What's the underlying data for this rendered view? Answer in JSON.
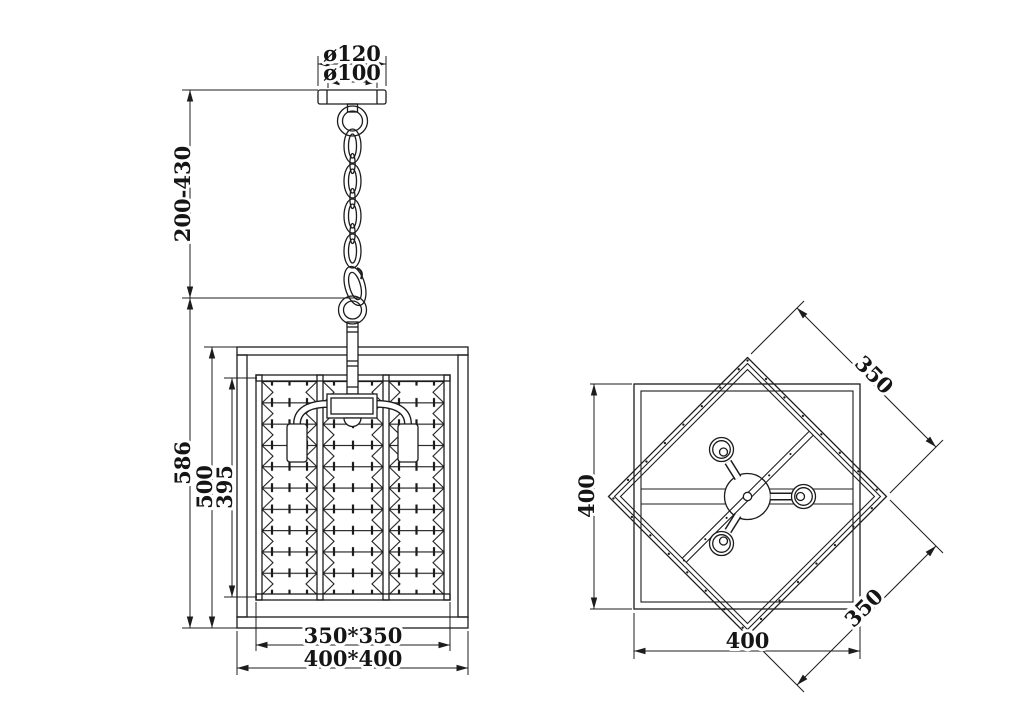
{
  "drawing": {
    "type": "pendant-chandelier-dimension-drawing",
    "front_view": {
      "canopy_diameter_outer": "ø120",
      "canopy_diameter_inner": "ø100",
      "chain_length_range": "200-430",
      "overall_body_height": "586",
      "frame_height": "500",
      "crystal_panel_height": "395",
      "crystal_cage_width": "350*350",
      "frame_width": "400*400"
    },
    "top_view": {
      "frame_depth": "400",
      "frame_width": "400",
      "inner_frame_side_top": "350",
      "inner_frame_side_bottom": "350"
    },
    "colors": {
      "line": "#1c1c1c",
      "background": "#ffffff"
    }
  }
}
